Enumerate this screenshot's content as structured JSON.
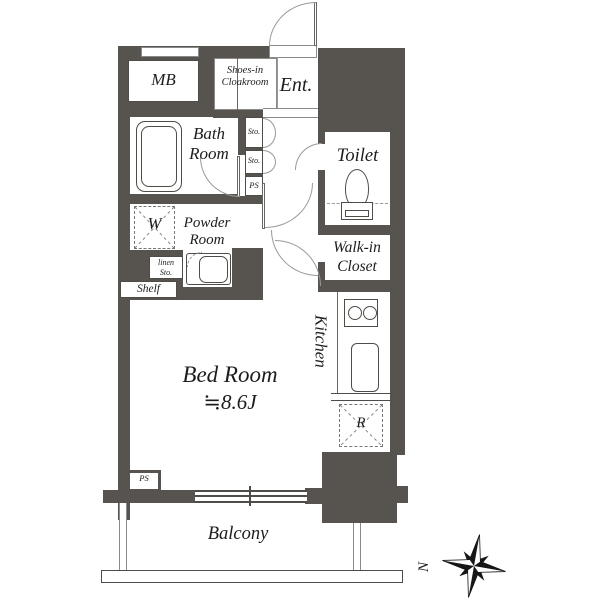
{
  "title": "apartment-floor-plan",
  "colors": {
    "wall": "#57534f",
    "fixture_line": "#4f4b47",
    "door_arc": "#999999",
    "text": "#1d1d1d",
    "background": "#ffffff"
  },
  "labels": {
    "mb": "MB",
    "shoes_line1": "Shoes-in",
    "shoes_line2": "Cloakroom",
    "entrance": "Ent.",
    "bath_line1": "Bath",
    "bath_line2": "Room",
    "sto_upper": "Sto.",
    "sto_lower": "Sto.",
    "ps_hall": "PS",
    "toilet": "Toilet",
    "powder_line1": "Powder",
    "powder_line2": "Room",
    "washer": "W",
    "linen_line1": "linen",
    "linen_line2": "Sto.",
    "shelf": "Shelf",
    "wic_line1": "Walk-in",
    "wic_line2": "Closet",
    "kitchen": "Kitchen",
    "fridge": "R",
    "bedroom_name": "Bed Room",
    "bedroom_area": "≒8.6J",
    "balcony": "Balcony",
    "ps_bottom": "PS",
    "compass_north": "N"
  }
}
